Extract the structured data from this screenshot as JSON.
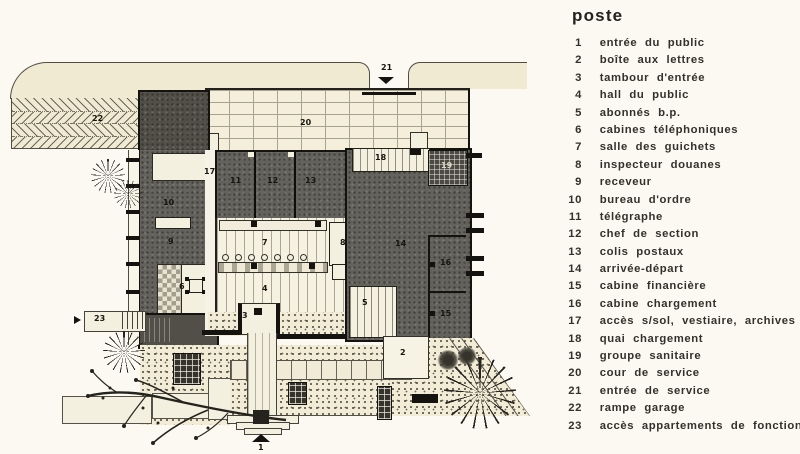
{
  "title": "poste",
  "legend": {
    "items": [
      {
        "num": "1",
        "label": "entrée du public"
      },
      {
        "num": "2",
        "label": "boîte aux lettres"
      },
      {
        "num": "3",
        "label": "tambour d'entrée"
      },
      {
        "num": "4",
        "label": "hall du public"
      },
      {
        "num": "5",
        "label": "abonnés b.p."
      },
      {
        "num": "6",
        "label": "cabines téléphoniques"
      },
      {
        "num": "7",
        "label": "salle des guichets"
      },
      {
        "num": "8",
        "label": "inspecteur douanes"
      },
      {
        "num": "9",
        "label": "receveur"
      },
      {
        "num": "10",
        "label": "bureau d'ordre"
      },
      {
        "num": "11",
        "label": "télégraphe"
      },
      {
        "num": "12",
        "label": "chef de section"
      },
      {
        "num": "13",
        "label": "colis postaux"
      },
      {
        "num": "14",
        "label": "arrivée-départ"
      },
      {
        "num": "15",
        "label": "cabine financière"
      },
      {
        "num": "16",
        "label": "cabine chargement"
      },
      {
        "num": "17",
        "label": "accès s/sol, vestiaire, archives"
      },
      {
        "num": "18",
        "label": "quai chargement"
      },
      {
        "num": "19",
        "label": "groupe sanitaire"
      },
      {
        "num": "20",
        "label": "cour de service"
      },
      {
        "num": "21",
        "label": "entrée de service"
      },
      {
        "num": "22",
        "label": "rampe garage"
      },
      {
        "num": "23",
        "label": "accès appartements de fonction"
      }
    ]
  },
  "plan": {
    "labels": {
      "r1": "1",
      "r2": "2",
      "r3": "3",
      "r4": "4",
      "r5": "5",
      "r6": "6",
      "r7": "7",
      "r8": "8",
      "r9": "9",
      "r10": "10",
      "r11": "11",
      "r12": "12",
      "r13": "13",
      "r14": "14",
      "r15": "15",
      "r16": "16",
      "r17": "17",
      "r18": "18",
      "r19": "19",
      "r20": "20",
      "r21": "21",
      "r22": "22",
      "r23": "23"
    }
  },
  "colors": {
    "paper": "#fbf9f1",
    "site_cream": "#f1ead3",
    "dark_room": "#63625c",
    "ink": "#16140f",
    "stripe_line": "#b9b29a",
    "brick_mortar": "#a8a292",
    "stipple_dot": "#4c483d",
    "text": "#33312b"
  }
}
